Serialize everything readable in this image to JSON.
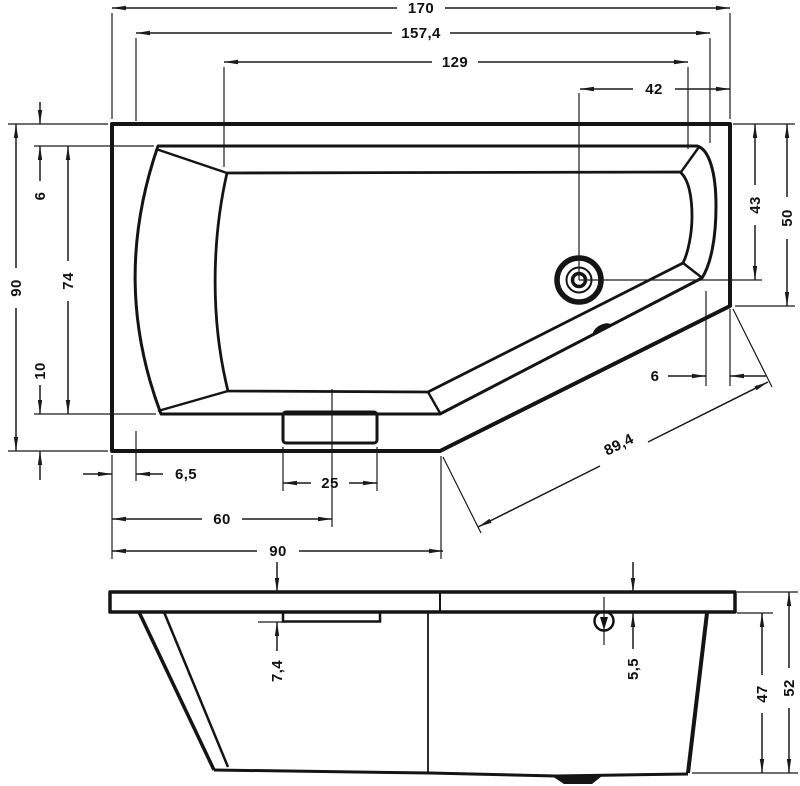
{
  "drawing": {
    "kind": "bathtub-technical-drawing",
    "unit": "cm",
    "line_color": "#141414",
    "background": "#ffffff",
    "views": {
      "top_view": "plan view of asymmetric corner bathtub",
      "front_view": "front elevation"
    },
    "dims": {
      "top": {
        "overall_width": "170",
        "rim_width": "157,4",
        "bowl_width": "129",
        "drain_from_right": "42",
        "overall_depth": "90",
        "bowl_opening_depth": "74",
        "rim_top_width": "6",
        "rim_bottom_width": "10",
        "right_side_height": "50",
        "drain_from_top": "43",
        "diagonal_rim_width": "6",
        "diagonal_edge_length": "89,4",
        "left_rim_width": "6,5",
        "panel_width": "25",
        "panel_center_offset": "60",
        "bottom_edge_length": "90"
      },
      "front": {
        "ledge_drop": "7,4",
        "rim_thickness": "5,5",
        "body_height": "47",
        "total_height": "52"
      }
    }
  }
}
